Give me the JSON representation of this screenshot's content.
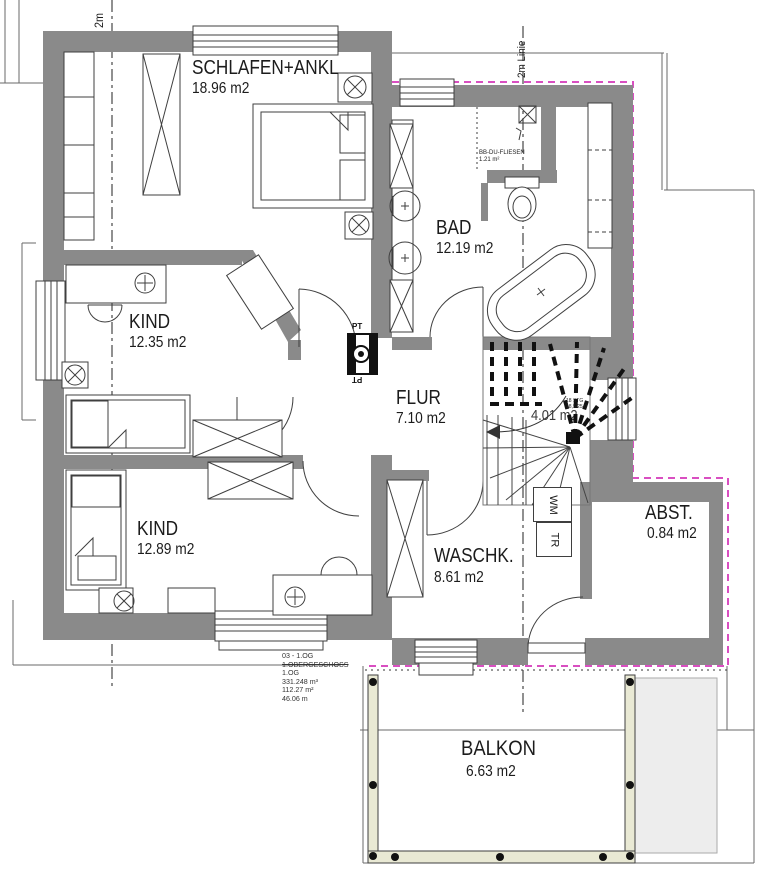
{
  "plan": {
    "rooms": {
      "schlafen": {
        "name": "SCHLAFEN+ANKL",
        "area": "18.96 m2"
      },
      "bad": {
        "name": "BAD",
        "area": "12.19 m2"
      },
      "kind1": {
        "name": "KIND",
        "area": "12.35 m2"
      },
      "flur": {
        "name": "FLUR",
        "area": "7.10 m2"
      },
      "kind2": {
        "name": "KIND",
        "area": "12.89 m2"
      },
      "waschk": {
        "name": "WASCHK.",
        "area": "8.61 m2"
      },
      "abst": {
        "name": "ABST.",
        "area": "0.84 m2"
      },
      "balkon": {
        "name": "BALKON",
        "area": "6.63 m2"
      },
      "treppe": {
        "area": "4.01 m2"
      }
    },
    "annotations": {
      "section_line_left": "2m",
      "section_line_right": "2m Linie",
      "shower_label": "BB-DU-FLIESEN",
      "shower_area": "1.21 m²",
      "stair_note_line1": "18 STG",
      "stair_note_line2": "18,5/25,0",
      "pt_top": "PT",
      "pt_bottom": "PT",
      "wm": "WM",
      "tr": "TR"
    },
    "info_block": {
      "line1": "03 - 1.OG",
      "line2": "1.OBERGESCHOSS",
      "line3": "1.OG",
      "line4": "331.248 m³",
      "line5": "112.27 m²",
      "line6": "46.06 m"
    },
    "colors": {
      "wall": "#8a8a8a",
      "line": "#3f3f3f",
      "boundary_magenta": "#d94fc1",
      "roof_fill": "#ededed",
      "railing_fill": "#e9e9d4"
    }
  }
}
